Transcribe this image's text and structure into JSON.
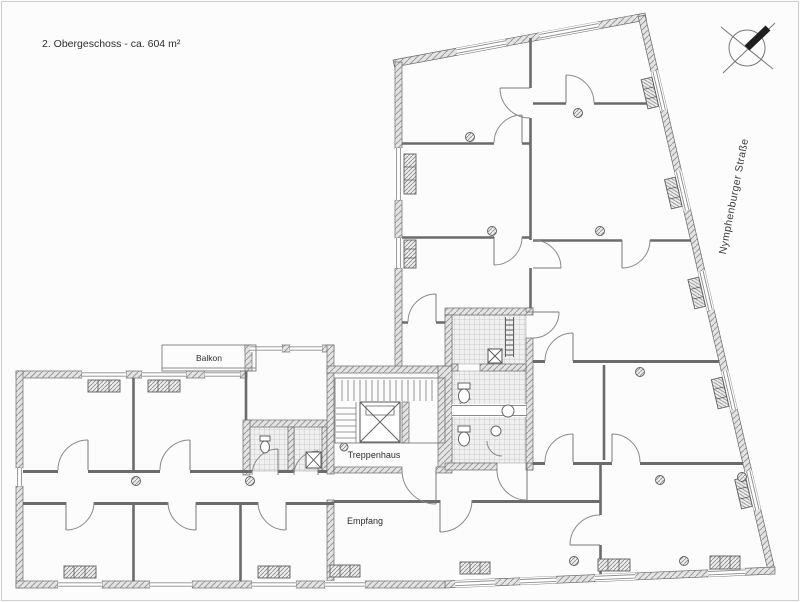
{
  "title": "2. Obergeschoss - ca. 604 m²",
  "street": "Nymphenburger Straße",
  "labels": {
    "balcony": "Balkon",
    "stairwell": "Treppenhaus",
    "reception": "Empfang"
  },
  "colors": {
    "paper": "#fcfcfc",
    "ink": "#6b6b6b",
    "hatch": "#9a9a9a",
    "text": "#2d2d2d",
    "needle": "#1f1f1f"
  },
  "compass": {
    "icon": "north-arrow-compass"
  }
}
